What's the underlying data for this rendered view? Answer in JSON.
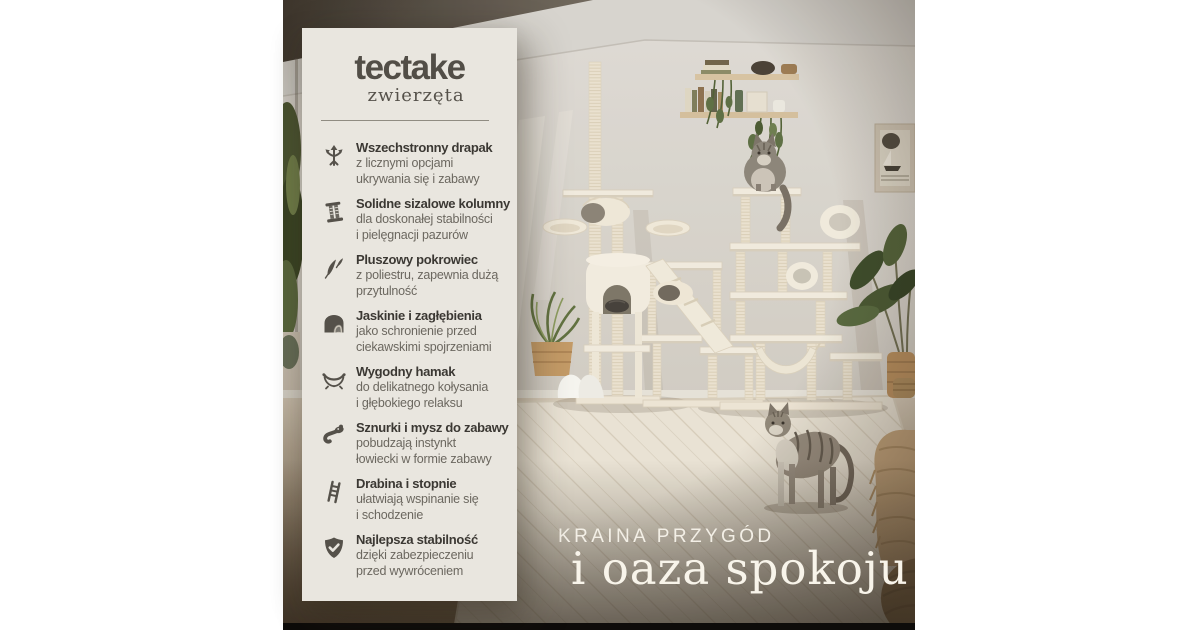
{
  "brand": {
    "name": "tectake",
    "subtitle": "zwierzęta"
  },
  "features": [
    {
      "icon": "multi-directional-arrows-icon",
      "title": "Wszechstronny drapak",
      "lines": [
        "z licznymi opcjami",
        "ukrywania się i zabawy"
      ]
    },
    {
      "icon": "sisal-column-icon",
      "title": "Solidne sizalowe kolumny",
      "lines": [
        "dla doskonałej stabilności",
        "i pielęgnacji pazurów"
      ]
    },
    {
      "icon": "feathers-icon",
      "title": "Pluszowy pokrowiec",
      "lines": [
        "z poliestru, zapewnia dużą",
        "przytulność"
      ]
    },
    {
      "icon": "cave-icon",
      "title": "Jaskinie i zagłębienia",
      "lines": [
        "jako schronienie przed",
        "ciekawskimi spojrzeniami"
      ]
    },
    {
      "icon": "hammock-icon",
      "title": "Wygodny hamak",
      "lines": [
        "do delikatnego kołysania",
        "i głębokiego relaksu"
      ]
    },
    {
      "icon": "mouse-toy-icon",
      "title": "Sznurki i mysz do zabawy",
      "lines": [
        "pobudzają instynkt",
        "łowiecki w formie zabawy"
      ]
    },
    {
      "icon": "ladder-icon",
      "title": "Drabina i stopnie",
      "lines": [
        "ułatwiają wspinanie się",
        "i schodzenie"
      ]
    },
    {
      "icon": "shield-check-icon",
      "title": "Najlepsza stabilność",
      "lines": [
        "dzięki zabezpieczeniu",
        "przed wywróceniem"
      ]
    }
  ],
  "headline": {
    "line1": "KRAINA PRZYGÓD",
    "line2": "i oaza spokoju"
  },
  "colors": {
    "panel_bg": "#e9e6df",
    "logo": "#524e47",
    "feature_title": "#3b3833",
    "feature_text": "#6b675f",
    "icon": "#55514a",
    "headline_text": "#f8f4ea",
    "photo_black_bar": "#0e0c0a"
  }
}
